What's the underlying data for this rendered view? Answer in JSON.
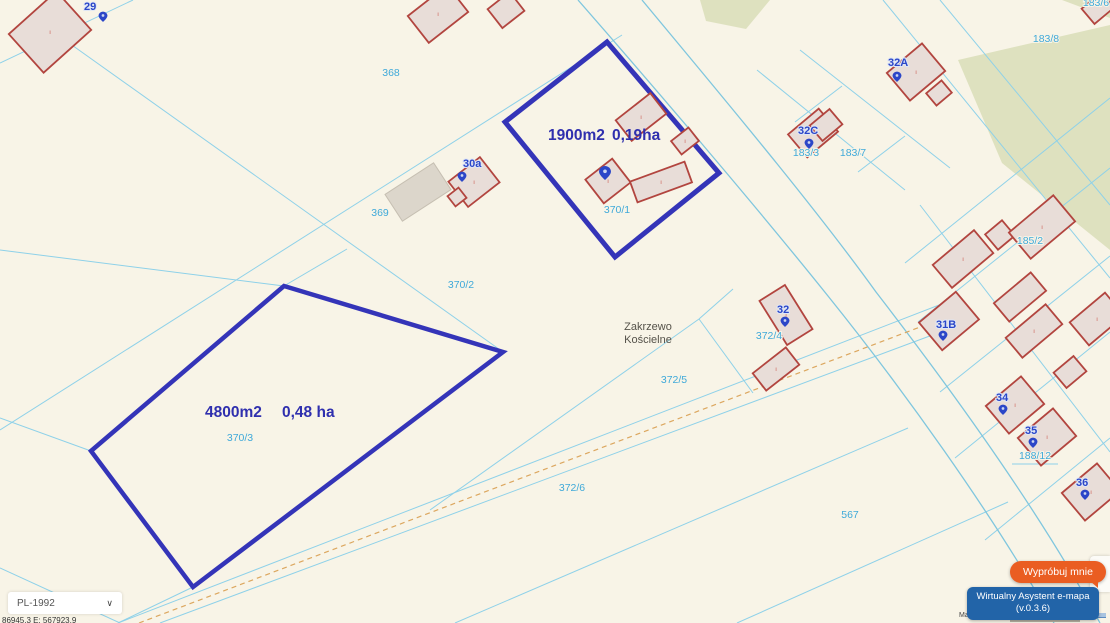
{
  "map": {
    "place": {
      "line1": "Zakrzewo",
      "line2": "Kościelne"
    },
    "area_labels": {
      "p370_1": {
        "m2": "1900m2",
        "ha": "0,19ha"
      },
      "p370_3": {
        "m2": "4800m2",
        "ha": "0,48 ha"
      }
    },
    "parcel_labels": {
      "368": "368",
      "369": "369",
      "370_1": "370/1",
      "370_2": "370/2",
      "370_3": "370/3",
      "372_4": "372/4",
      "372_5": "372/5",
      "372_6": "372/6",
      "567": "567",
      "183_3": "183/3",
      "183_7": "183/7",
      "183_8": "183/8",
      "183_6": "183/6",
      "185_2": "185/2",
      "188_12": "188/12"
    },
    "address_labels": {
      "a29": "29",
      "a30a": "30a",
      "a32A": "32A",
      "a32C": "32C",
      "a32": "32",
      "a31B": "31B",
      "a34": "34",
      "a35": "35",
      "a36": "36"
    },
    "building_mark": "i",
    "colors": {
      "background": "#f8f4e7",
      "parcel_highlight": "#3434b8",
      "cadastral_line": "#8ed1e9",
      "road_line": "#7fc6de",
      "area_label": "#2f2fae",
      "parcel_label": "#3fa9d9",
      "address_label": "#2b46c8",
      "building_stroke": "#b2453f",
      "building_fill": "#e8ddd8",
      "building_mark": "#c23b30",
      "gray_building_fill": "#dcd6cb",
      "gray_building_stroke": "#c6bfb2",
      "green_area": "#dee1bf",
      "dashed_utility": "#dca75f",
      "place_label": "#55524a"
    }
  },
  "controls": {
    "crs": {
      "value": "PL-1992"
    },
    "coordinates": "86945.3   E: 567923.9",
    "try_me": "Wypróbuj mnie",
    "assistant": {
      "line1": "Wirtualny Asystent e-mapa",
      "line2": "(v.0.3.6)"
    },
    "attribution": "Map tiles"
  }
}
